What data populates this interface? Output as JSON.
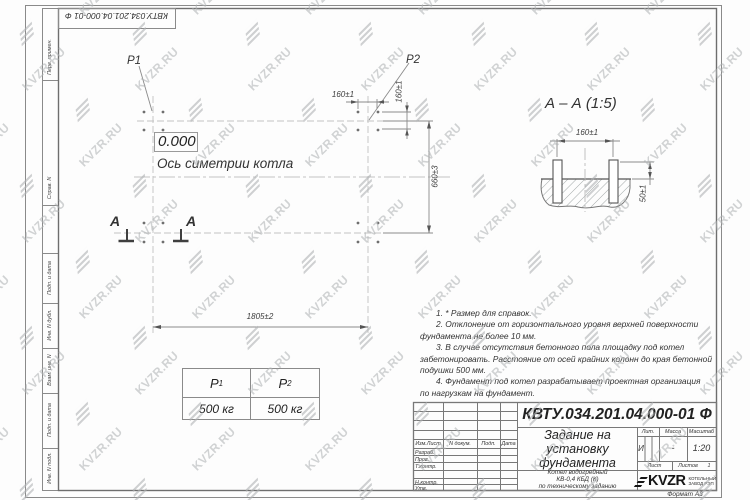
{
  "doc_number": "КВТУ.034.201.04.000-01 Ф",
  "format_label": "Формат А3",
  "watermark": {
    "text": "KVZR.RU",
    "color": "#b0b3b5"
  },
  "margin": {
    "perv": "Перв. примен.",
    "sprav": "Справ. N",
    "podp1": "Подп. и дата",
    "inv_dubl": "Инв. N дубл.",
    "vzam": "Взам. инв. N",
    "podp2": "Подп. и дата",
    "inv_podl": "Инв. N подл."
  },
  "plan": {
    "p1": "P1",
    "p2": "P2",
    "level": "0.000",
    "axis": "Ось симетрии котла",
    "dim_pitch_h": "160±1",
    "dim_pitch_v": "160±1",
    "dim_height": "660±3",
    "dim_width": "1805±2",
    "section_a_left": "A",
    "section_a_right": "A"
  },
  "section": {
    "title": "А – А (1:5)",
    "dim_w": "160±1",
    "dim_h": "50±1"
  },
  "loads": {
    "p1_base": "P",
    "p1_sub": "1",
    "p2_base": "P",
    "p2_sub": "2",
    "v1": "500 кг",
    "v2": "500 кг"
  },
  "notes": {
    "l1": "1. * Размер для справок.",
    "l2": "2. Отклонение от горизонтального уровня верхней поверхности",
    "l3": "фундамента не более 10 мм.",
    "l4": "3. В случае отсутствия бетонного пола площадку под котел",
    "l5": "забетонировать. Расстояние от осей крайних колонн до края бетонной",
    "l6": "подушки 500 мм.",
    "l7": "4. Фундамент под котел разрабатывает проектная организация",
    "l8": "по нагрузкам на фундамент."
  },
  "tb": {
    "izm": "Изм.Лист",
    "ndok": "N докум.",
    "podp": "Подп.",
    "data": "Дата",
    "razrab": "Разраб.",
    "prov": "Пров.",
    "tkontr": "Т.контр.",
    "nkontr": "Н.контр.",
    "utv": "Утв.",
    "title1": "Задание на",
    "title2": "установку",
    "title3": "фундамента",
    "prod1": "Котел водогрейный",
    "prod2": "КВ-0,4  КБД  (К)",
    "prod3": "по техническому заданию",
    "lit_h": "Лит.",
    "lit_v": "И",
    "massa_h": "Масса",
    "massa_v": "-",
    "scale_h": "Масштаб",
    "scale_v": "1:20",
    "list_h": "Лист",
    "listov_h": "Листов",
    "listov_v": "1",
    "logo": "KVZR",
    "company1": "КОТЕЛЬНЫЙ",
    "company2": "ЗАВОД РЭП"
  }
}
